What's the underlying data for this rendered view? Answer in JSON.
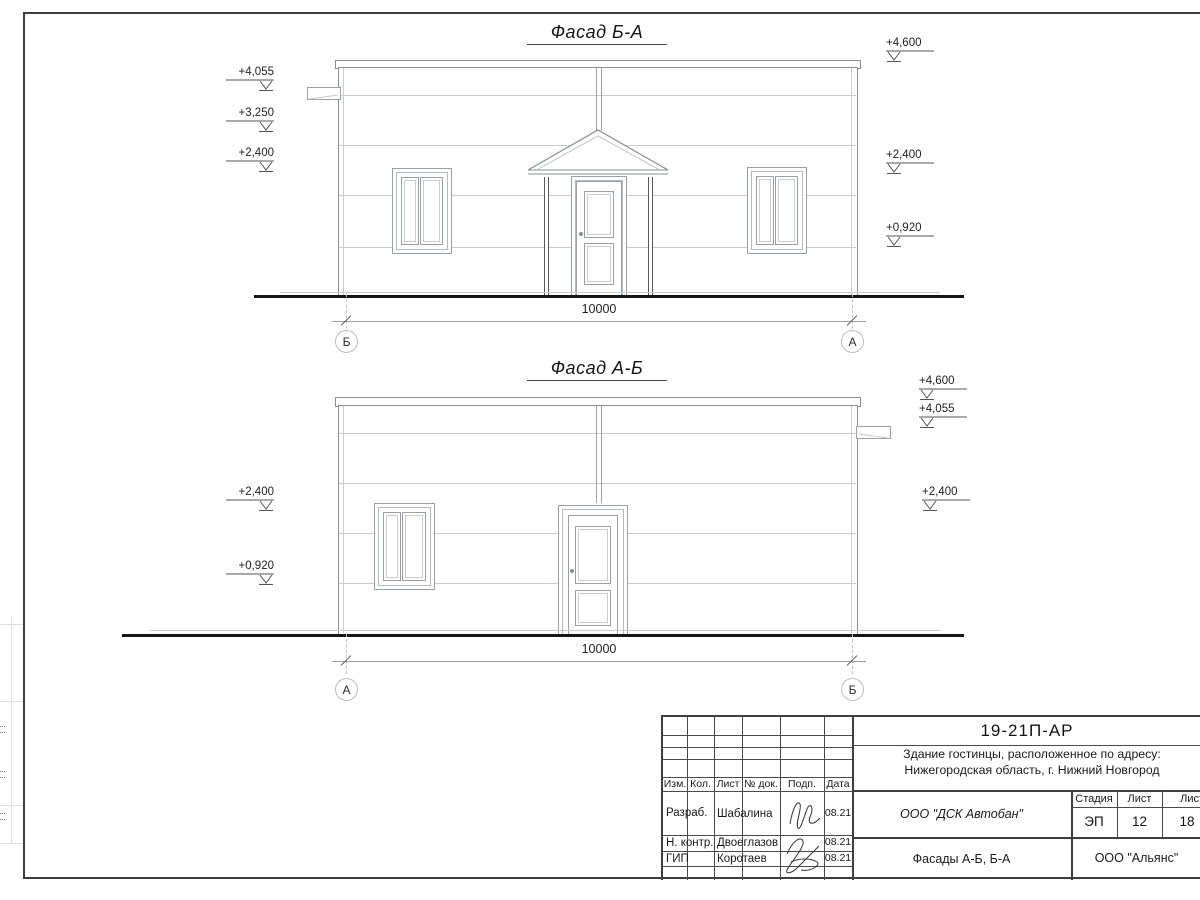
{
  "drawing": {
    "facades": [
      {
        "title": "Фасад Б-А",
        "dim": "10000",
        "axis_left": "Б",
        "axis_right": "А",
        "marks_left": [
          "+4,055",
          "+3,250",
          "+2,400"
        ],
        "marks_right": [
          "+4,600",
          "+2,400",
          "+0,920"
        ]
      },
      {
        "title": "Фасад А-Б",
        "dim": "10000",
        "axis_left": "А",
        "axis_right": "Б",
        "marks_left": [
          "+2,400",
          "+0,920"
        ],
        "marks_right": [
          "+4,600",
          "+4,055",
          "+2,400"
        ]
      }
    ]
  },
  "title_block": {
    "code": "19-21П-АР",
    "object_line1": "Здание гостинцы, расположенное по адресу:",
    "object_line2": "Нижегородская область, г. Нижний Новгород",
    "designer_org": "ООО \"ДСК Автобан\"",
    "stage_label": "Стадия",
    "sheet_label": "Лист",
    "sheets_label": "Листов",
    "stage": "ЭП",
    "sheet": "12",
    "sheets": "18",
    "sheet_title": "Фасады А-Б, Б-А",
    "client_org": "ООО \"Альянс\"",
    "columns": [
      "Изм.",
      "Кол.",
      "Лист",
      "№ док.",
      "Подп.",
      "Дата"
    ],
    "signature_rows": [
      {
        "role": "Разраб.",
        "name": "Шабалина",
        "date": "08.21"
      },
      {
        "role": "Н. контр.",
        "name": "Двоеглазов",
        "date": "08.21"
      },
      {
        "role": "ГИП",
        "name": "Коротаев",
        "date": "08.21"
      }
    ]
  }
}
